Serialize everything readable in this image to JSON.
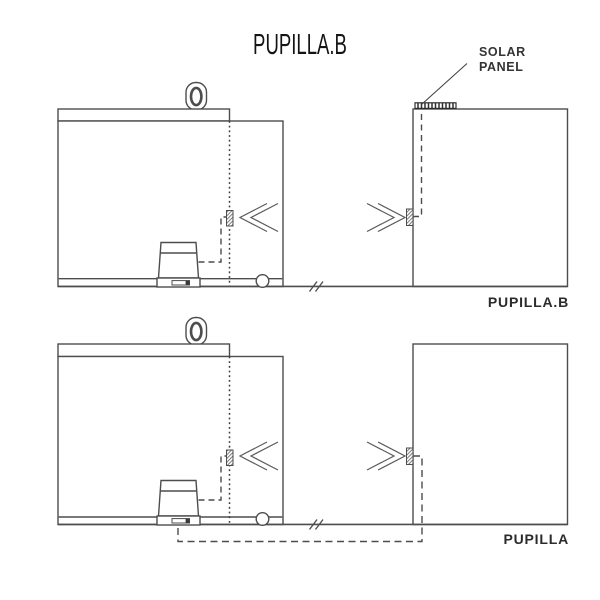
{
  "title": "PUPILLA.B",
  "solar_panel": {
    "line1": "SOLAR",
    "line2": "PANEL"
  },
  "variants": {
    "top_label": "PUPILLA.B",
    "bottom_label": "PUPILLA"
  },
  "colors": {
    "background": "#ffffff",
    "line": "#4d4d4d",
    "dark_detail": "#3a3a3a",
    "title_text": "#141414",
    "label_text": "#2b2b2b",
    "annotation_text": "#333333"
  },
  "icons": {
    "eye-ring-icon": "oval lifting ring outline",
    "gearmotor-icon": "trapezoid sliding-gate motor with base slot",
    "solar-panel-icon": "hatched cell bar on top of column",
    "photocell-icon": "small hatched rectangle",
    "signal-waves-icon": "double chevron beam",
    "distance-break-icon": "double slash on ground line",
    "wheel-icon": "small circle on ground"
  }
}
